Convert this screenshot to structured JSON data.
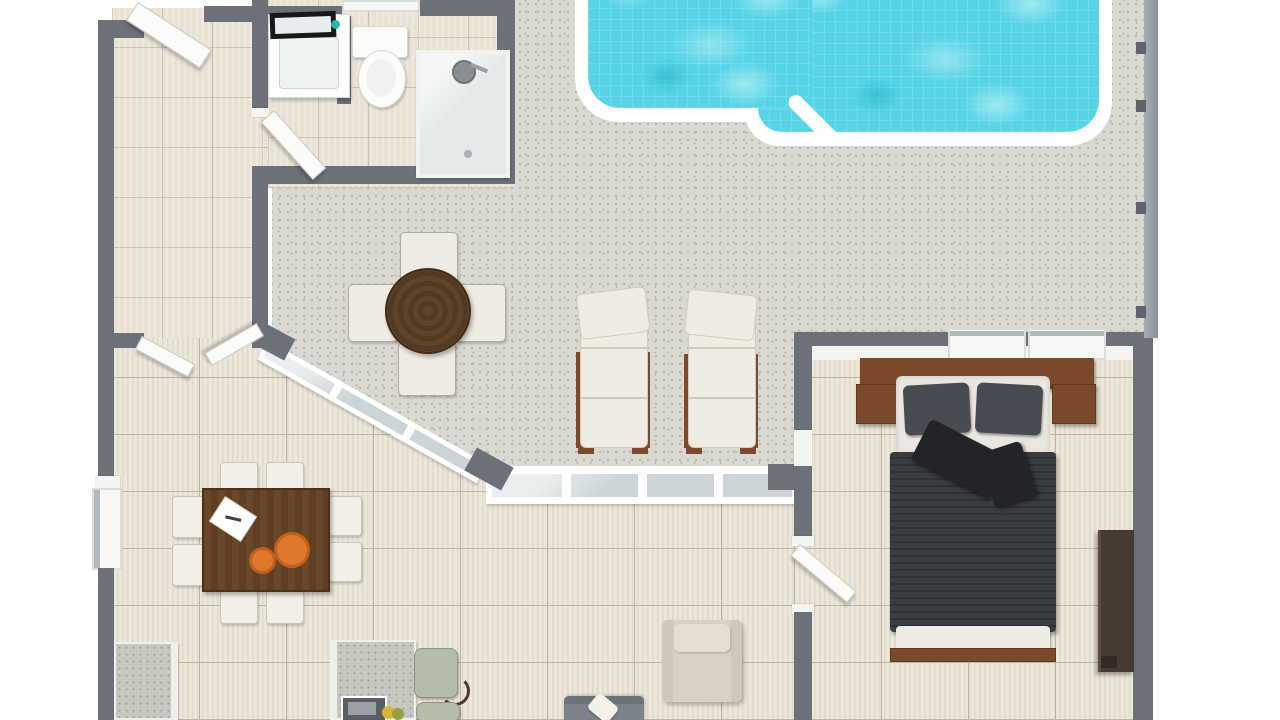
{
  "scene": {
    "type": "floor-plan-3d-render",
    "view": "top-down",
    "description": "3D rendered floor plan of a house with swimming pool, patio, bedroom, bathroom, kitchen and living-dining area"
  },
  "palette": {
    "wall": "#6c7078",
    "wall-cap": "#f4f4f1",
    "fence": "#a7adb4",
    "fence-post": "#5f646c",
    "floor-tile": "#eae3d3",
    "floor-plank": "#ece7d9",
    "grout": "#c9c0ab",
    "plank-line": "#bdb5a0",
    "patio": "#d9d9d2",
    "speckle": "#b4b4aa",
    "water": "#56d4e6",
    "water-light": "#9fe9f2",
    "coping": "#ffffff",
    "glass": "#ccd5d6",
    "door": "#fbfbfa",
    "wood-dark": "#58402a",
    "wood-mid": "#7a4a2b",
    "duvet": "#393c41",
    "duvet-stripe": "#2e3135",
    "pillow": "#484b51",
    "cushion-black": "#222427",
    "linen": "#efece3",
    "mattress": "#e9e7e0",
    "orange": "#df772d",
    "orange-dark": "#c05f1e",
    "sage": "#b5bca8",
    "sofa": "#7c838b",
    "armchair": "#d8d2c2",
    "armchair-light": "#e5dfd1",
    "counter": "#c6c8c0",
    "espresso": "#473a33",
    "teal-accent": "#2ab5aa"
  },
  "rooms": [
    {
      "id": "utility-room",
      "label": "Utility room"
    },
    {
      "id": "bathroom",
      "label": "Bathroom"
    },
    {
      "id": "pool-patio",
      "label": "Pool patio"
    },
    {
      "id": "living-dining",
      "label": "Living and dining room"
    },
    {
      "id": "kitchen",
      "label": "Kitchen"
    },
    {
      "id": "bedroom",
      "label": "Bedroom"
    }
  ],
  "furniture": [
    {
      "id": "swimming-pool",
      "label": "Swimming pool"
    },
    {
      "id": "outdoor-dining-table",
      "label": "Round outdoor table"
    },
    {
      "id": "outdoor-chair",
      "label": "Outdoor chair"
    },
    {
      "id": "sun-lounger",
      "label": "Sun lounger"
    },
    {
      "id": "double-bed",
      "label": "Double bed with dark duvet"
    },
    {
      "id": "headboard",
      "label": "Headboard with nightstands"
    },
    {
      "id": "dresser",
      "label": "Dresser"
    },
    {
      "id": "dining-table",
      "label": "Dining table"
    },
    {
      "id": "dining-chair",
      "label": "Dining chair"
    },
    {
      "id": "kitchen-counter",
      "label": "Kitchen counter"
    },
    {
      "id": "kitchen-island",
      "label": "Kitchen island with sink"
    },
    {
      "id": "bar-stool",
      "label": "Bar stool"
    },
    {
      "id": "armchair",
      "label": "Armchair"
    },
    {
      "id": "sofa",
      "label": "Sofa"
    },
    {
      "id": "bathroom-vanity",
      "label": "Bathroom vanity with mirror"
    },
    {
      "id": "toilet",
      "label": "Toilet"
    },
    {
      "id": "shower",
      "label": "Shower"
    },
    {
      "id": "pool-fence",
      "label": "Pool fence"
    },
    {
      "id": "sliding-door",
      "label": "Sliding glass doors"
    },
    {
      "id": "fruit-bowl",
      "label": "Fruit bowl"
    }
  ],
  "counts": {
    "outdoor_chairs": 4,
    "sun_loungers": 2,
    "dining_chairs": 8,
    "bar_stools": 2,
    "bedroom_windows": 2,
    "doors": 5
  }
}
